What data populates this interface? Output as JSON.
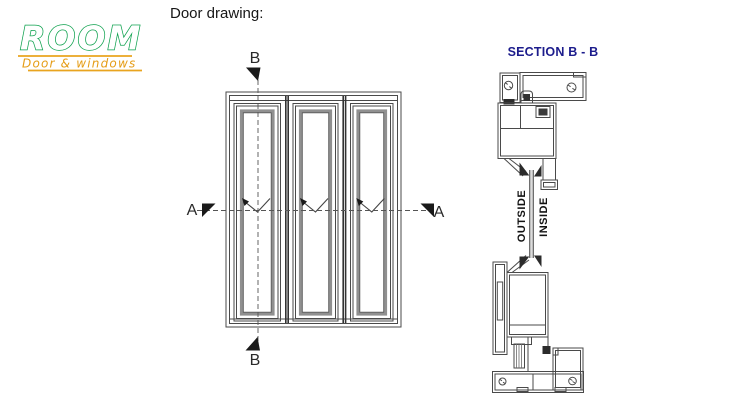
{
  "logo": {
    "name": "ROOM",
    "subtitle": "Door & windows",
    "name_color": "#0ba04c",
    "accent_color": "#e9a41f"
  },
  "header": {
    "title": "Door drawing:"
  },
  "elevation": {
    "panel_count": 3,
    "labels": {
      "top": "B",
      "bottom": "B",
      "left": "A",
      "right": "A"
    }
  },
  "section_view": {
    "title": "SECTION B - B",
    "title_color": "#1c1c8c",
    "outside_label": "OUTSIDE",
    "inside_label": "INSIDE"
  }
}
